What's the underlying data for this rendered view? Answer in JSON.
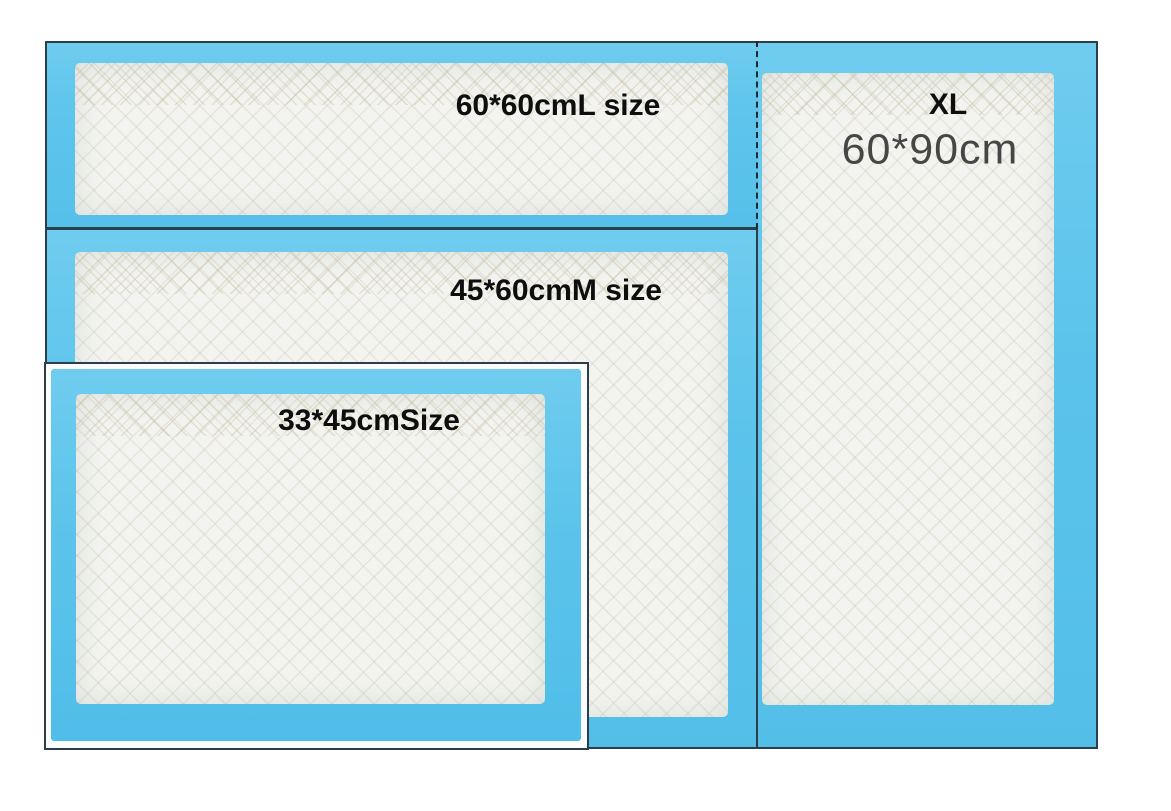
{
  "photo": {
    "description": "Size comparison photo of four blue-bordered white disposable absorbent pads",
    "background_color": "#ffffff"
  },
  "colors": {
    "pad_edge_blue": "#5fc5ec",
    "absorbent_core_white": "#f3f4f0",
    "pad_outline_dark": "#2c3e4a",
    "size_label_black": "#0e0e0e",
    "xl_dimension_gray": "#464646"
  },
  "pads": {
    "large": {
      "label": "60*60cmL size"
    },
    "medium": {
      "label": "45*60cmM size"
    },
    "small": {
      "label": "33*45cmSize"
    },
    "xlarge": {
      "size_code": "XL",
      "dimensions": "60*90cm"
    }
  }
}
